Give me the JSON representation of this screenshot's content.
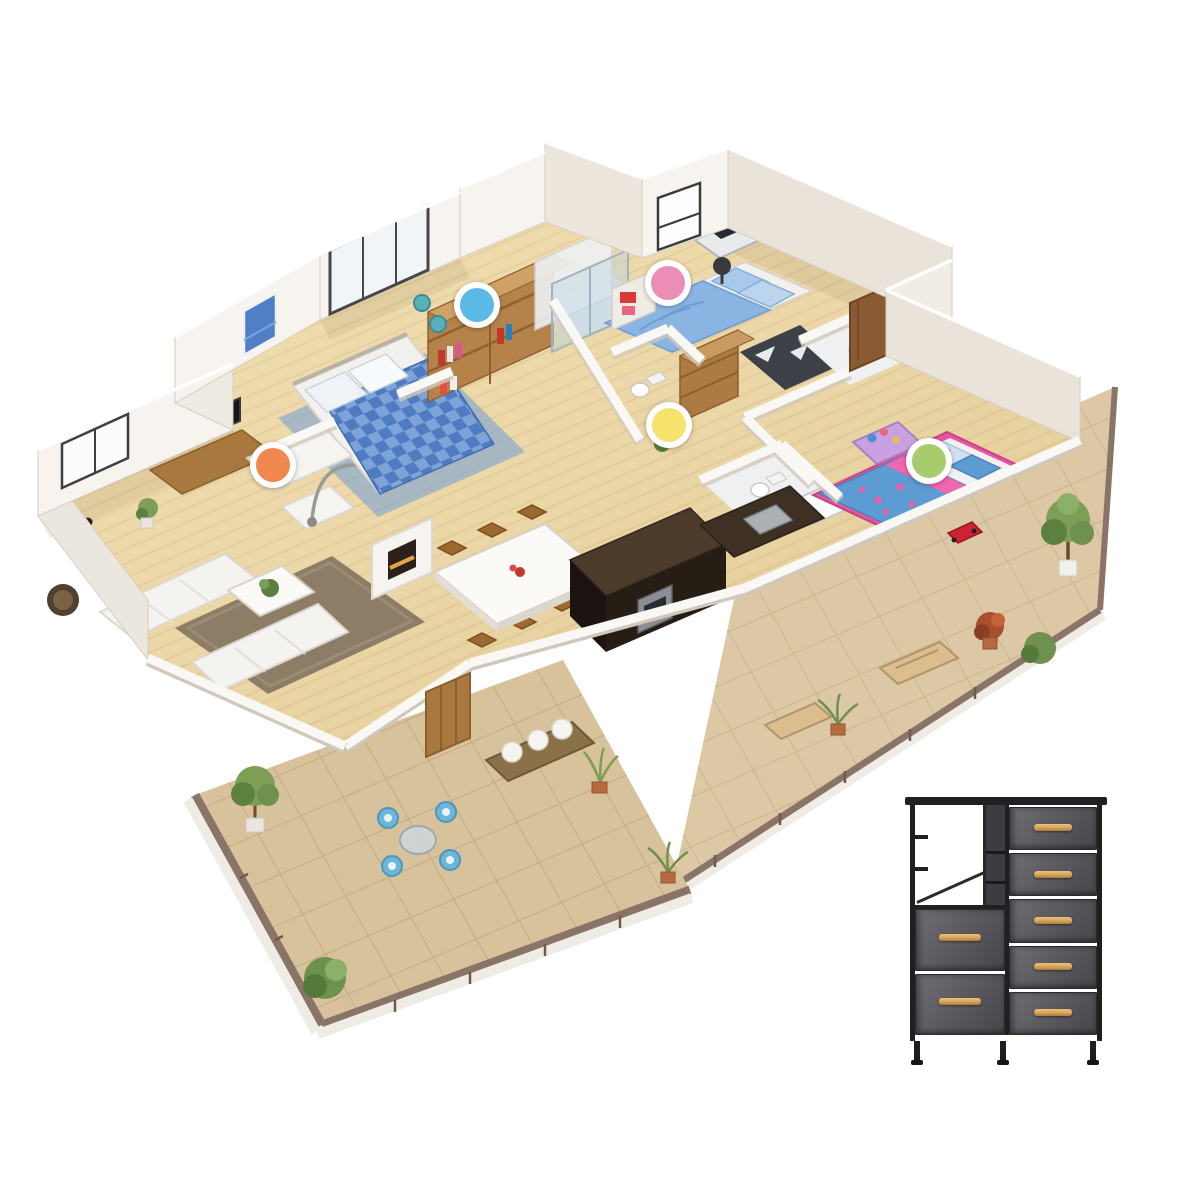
{
  "scene": {
    "type": "3d-isometric-floorplan-render",
    "marker_outer_radius": 23,
    "marker_inner_radius": 17,
    "markers": [
      {
        "id": "blue",
        "color": "#5BB9E7",
        "x": 477,
        "y": 305,
        "room": "walk-in-closet"
      },
      {
        "id": "pink",
        "color": "#EC8DB6",
        "x": 668,
        "y": 283,
        "room": "guest-bedroom"
      },
      {
        "id": "orange",
        "color": "#F0874F",
        "x": 273,
        "y": 465,
        "room": "living-room"
      },
      {
        "id": "yellow",
        "color": "#F5E36E",
        "x": 669,
        "y": 425,
        "room": "hallway"
      },
      {
        "id": "green",
        "color": "#A8CB6B",
        "x": 929,
        "y": 461,
        "room": "kids-bedroom"
      }
    ]
  },
  "product": {
    "name": "fabric-dresser-storage-tower",
    "frame_color": "#202022",
    "fabric_color": "#5b5b60",
    "handle_color": "#d6a25a",
    "left_drawers": 2,
    "right_drawers": 5,
    "has_open_shelf": true,
    "position": {
      "x": 908,
      "y": 797,
      "width": 196,
      "height": 268
    }
  },
  "palette": {
    "background": "#ffffff",
    "wood_floor": "#ecd8a9",
    "terrace_tile": "#d8c29c",
    "wall": "#f7f4ef",
    "wall_shade": "#e9e3d9",
    "railing": "#7d685c",
    "dark_wood": "#261d15",
    "mid_wood": "#b5824a",
    "bed_blue": "#8ab5e2",
    "kids_blue": "#5d9bd3",
    "kids_pink": "#f067b0",
    "plant_green": "#7d9e57"
  }
}
